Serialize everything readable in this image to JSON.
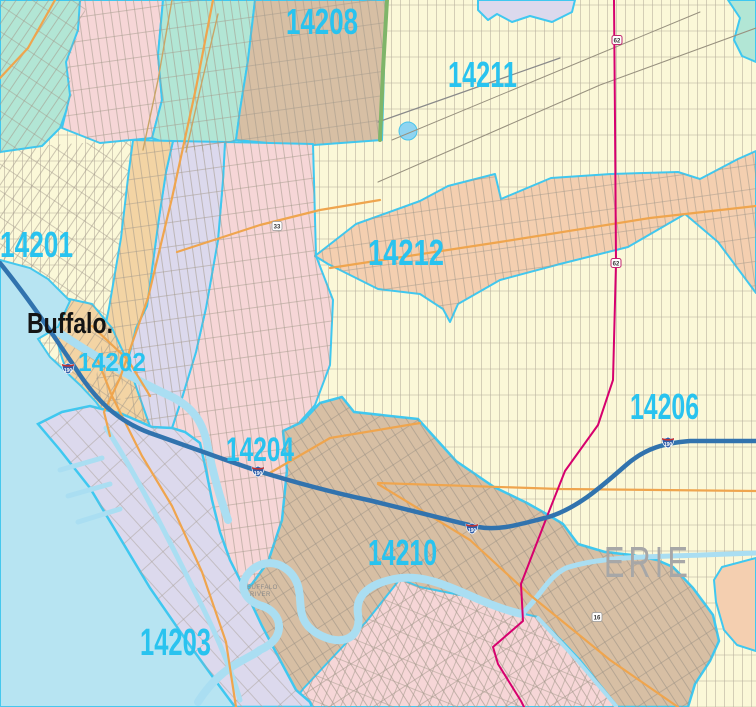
{
  "map": {
    "city_label": "Buffalo.",
    "county_label": "ERIE",
    "river_label": {
      "line1": "BUFFALO",
      "line2": "RIVER"
    },
    "zip_labels": [
      {
        "zip": "14208"
      },
      {
        "zip": "14211"
      },
      {
        "zip": "14201"
      },
      {
        "zip": "14212"
      },
      {
        "zip": "14202"
      },
      {
        "zip": "14206"
      },
      {
        "zip": "14204"
      },
      {
        "zip": "14210"
      },
      {
        "zip": "14203"
      }
    ],
    "shields": {
      "interstate": "190",
      "us62": "62",
      "route33": "33",
      "route16": "16"
    },
    "colors": {
      "base_yellow": "#fbf8d8",
      "teal": "#b2e6d5",
      "pink": "#f6d6d7",
      "tan": "#d7bfa4",
      "lavender": "#dcd9ed",
      "peach": "#f4cfb0",
      "downtown_sand": "#f3d4a4",
      "water": "#b7e4f2",
      "zip_boundary_cyan": "#3fc8f0",
      "major_road_orange": "#efa54e",
      "interstate_blue": "#3173ae",
      "state_route_magenta": "#d6006e",
      "zip_label_cyan": "#29c3ef",
      "county_label_gray": "#a7a7a7",
      "parkway_green": "#7fb569",
      "street_gray": "#a79f90"
    }
  }
}
